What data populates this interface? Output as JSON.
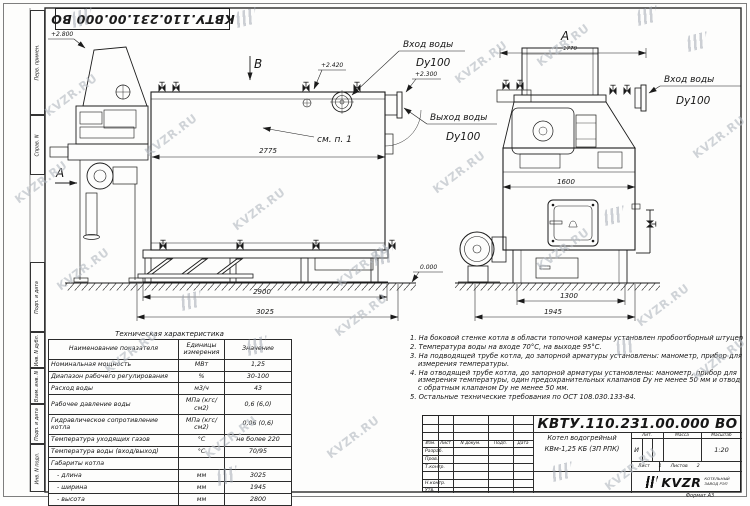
{
  "sheet": {
    "doc_number_stamp": "КВТУ.110.231.00.000  ВО",
    "format_label": "Формат  А3",
    "watermark_text": "KVZR.RU"
  },
  "margin_labels": [
    "Перв. примен.",
    "Справ. N",
    "Подп. и дата",
    "Инв. N дубл.",
    "Взам. инв. N",
    "Подп. и дата",
    "Инв. N подл."
  ],
  "side_view": {
    "section_b": "B",
    "section_a": "A",
    "elev_hood": "+2.800",
    "elev_top": "+2.420",
    "elev_outlet": "+2.300",
    "elev_ground": "0.000",
    "see_note": "см. п. 1",
    "inlet_title": "Вход воды",
    "inlet_dn": "Dy100",
    "outlet_title": "Выход воды",
    "outlet_dn": "Dy100",
    "dim_body": "2775",
    "dim_frame": "2900",
    "dim_overall": "3025"
  },
  "front_view": {
    "view_label": "A",
    "dim_top": "1770",
    "dim_body": "1600",
    "dim_base": "1300",
    "dim_overall": "1945",
    "inlet_title": "Вход воды",
    "inlet_dn": "Dy100"
  },
  "tech_table": {
    "title": "Техническая характеристика",
    "headers": [
      "Наименование показателя",
      "Единицы измерения",
      "Значение"
    ],
    "rows": [
      [
        "Номинальная мощность",
        "МВт",
        "1,25"
      ],
      [
        "Диапазон рабочего регулирования",
        "%",
        "30-100"
      ],
      [
        "Расход воды",
        "м3/ч",
        "43"
      ],
      [
        "Рабочее давление воды",
        "МПа (кгс/см2)",
        "0,6 (6,0)"
      ],
      [
        "Гидравлическое сопротивление котла",
        "МПа (кгс/см2)",
        "0,06 (0,6)"
      ],
      [
        "Температура уходящих газов",
        "°С",
        "не более 220"
      ],
      [
        "Температура воды (вход/выход)",
        "°С",
        "70/95"
      ],
      [
        "Габариты котла",
        "",
        ""
      ],
      [
        "   - длина",
        "мм",
        "3025"
      ],
      [
        "   - ширина",
        "мм",
        "1945"
      ],
      [
        "   - высота",
        "мм",
        "2800"
      ]
    ]
  },
  "notes": [
    "1.  На боковой стенке котла в области топочной камеры установлен пробоотборный штуцер",
    "2.  Температура воды на входе 70°С, на выходе 95°С.",
    "3.  На подводящей трубе котла, до запорной арматуры установлены: манометр, прибор для измерения температуры.",
    "4.  На отводящей трубе котла, до запорной арматуры установлены: манометр, прибор для измерения температуры, один предохранительных клапанов Dу не менее 50 мм и отвод с обратным клапаном Dу не менее 50 мм.",
    "5.  Остальные технические требования по ОСТ 108.030.133-84."
  ],
  "title_block": {
    "doc_number": "КВТУ.110.231.00.000  ВО",
    "product_name_line1": "Котел водогрейный",
    "product_name_line2": "КВм-1,25 КБ  (ЗП РПК)",
    "header_cells": [
      "Изм.",
      "Лист",
      "N докум.",
      "Подп.",
      "Дата"
    ],
    "row_labels": [
      "Разраб.",
      "Пров.",
      "Т.контр.",
      "Н.контр.",
      "Утв."
    ],
    "lit_header": "Лит.",
    "mass_header": "Масса",
    "scale_header": "Масштаб",
    "lit_value": "И",
    "scale_value": "1:20",
    "sheet_label": "Лист",
    "sheet_value": "1",
    "sheets_label": "Листов",
    "sheets_value": "2",
    "company_logo": "KVZR",
    "company_line1": "КОТЕЛЬНЫЙ",
    "company_line2": "ЗАВОД РЭП"
  },
  "watermarks": {
    "items": [
      {
        "x": 40,
        "y": 88,
        "t": "text"
      },
      {
        "x": 140,
        "y": 128,
        "t": "text"
      },
      {
        "x": 10,
        "y": 175,
        "t": "text"
      },
      {
        "x": 228,
        "y": 202,
        "t": "text"
      },
      {
        "x": 52,
        "y": 262,
        "t": "text"
      },
      {
        "x": 332,
        "y": 258,
        "t": "text"
      },
      {
        "x": 450,
        "y": 55,
        "t": "text"
      },
      {
        "x": 532,
        "y": 38,
        "t": "text"
      },
      {
        "x": 688,
        "y": 130,
        "t": "text"
      },
      {
        "x": 632,
        "y": 298,
        "t": "text"
      },
      {
        "x": 532,
        "y": 242,
        "t": "text"
      },
      {
        "x": 330,
        "y": 308,
        "t": "text"
      },
      {
        "x": 200,
        "y": 430,
        "t": "text"
      },
      {
        "x": 322,
        "y": 430,
        "t": "text"
      },
      {
        "x": 688,
        "y": 352,
        "t": "text"
      },
      {
        "x": 428,
        "y": 165,
        "t": "text"
      },
      {
        "x": 100,
        "y": 345,
        "t": "text"
      },
      {
        "x": 600,
        "y": 462,
        "t": "text"
      },
      {
        "x": 68,
        "y": 10,
        "t": "mark"
      },
      {
        "x": 232,
        "y": 10,
        "t": "mark"
      },
      {
        "x": 633,
        "y": 8,
        "t": "mark"
      },
      {
        "x": 683,
        "y": 34,
        "t": "mark"
      },
      {
        "x": 600,
        "y": 208,
        "t": "mark"
      },
      {
        "x": 370,
        "y": 248,
        "t": "mark"
      },
      {
        "x": 177,
        "y": 293,
        "t": "mark"
      },
      {
        "x": 243,
        "y": 338,
        "t": "mark"
      },
      {
        "x": 612,
        "y": 338,
        "t": "mark"
      },
      {
        "x": 213,
        "y": 468,
        "t": "mark"
      },
      {
        "x": 548,
        "y": 464,
        "t": "mark"
      }
    ]
  }
}
